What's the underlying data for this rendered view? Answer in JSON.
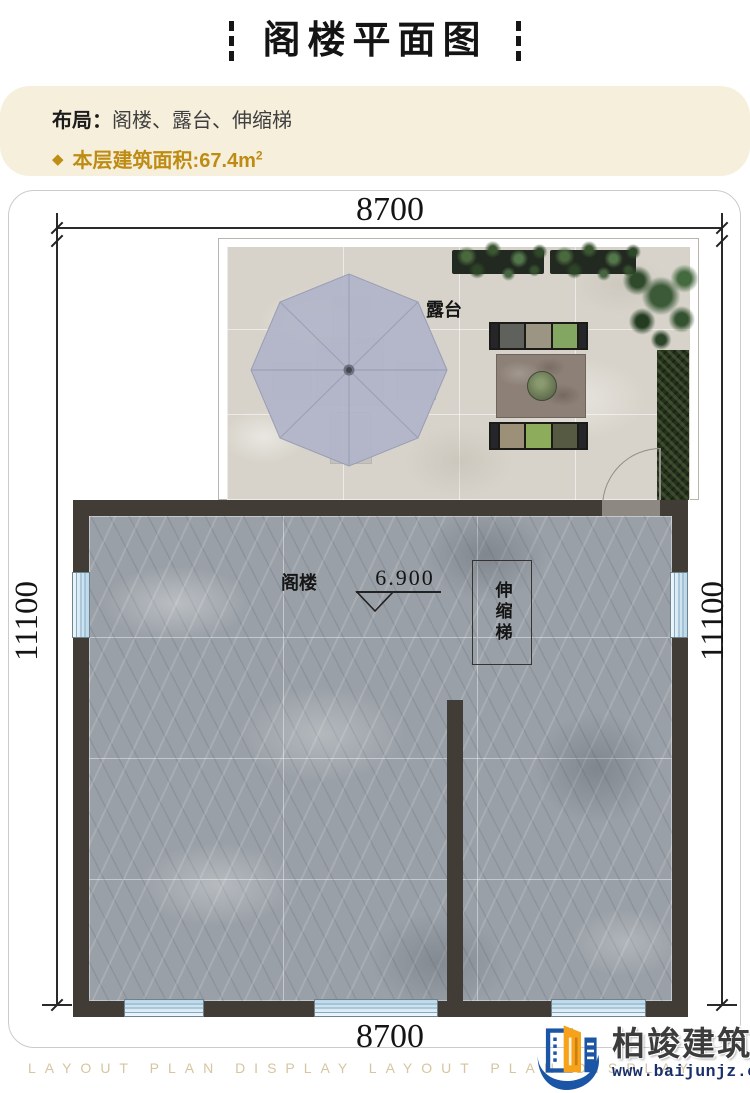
{
  "header": {
    "title": "阁楼平面图"
  },
  "info": {
    "layout_label": "布局：",
    "layout_value": "阁楼、露台、伸缩梯",
    "bullet": "◆",
    "area_label": "本层建筑面积:67.4m",
    "area_sup": "2",
    "accent_color": "#bf8c13",
    "bg_color": "#f6efdc"
  },
  "plan": {
    "dim_top": "8700",
    "dim_bottom": "8700",
    "dim_left": "11100",
    "dim_right": "11100",
    "terrace_label": "露台",
    "attic_label": "阁楼",
    "ladder_label": "伸缩梯",
    "elevation": "6.900",
    "colors": {
      "wall": "#413d36",
      "marble_floor": "#9aa0a7",
      "terrace_floor": "#d7d3ca",
      "umbrella": "#b1b5c8",
      "window": "#cfe4f2"
    }
  },
  "footer": {
    "watermark": "LAYOUT PLAN DISPLAY LAYOUT PLAN DISPLAY",
    "brand": "柏竣建筑",
    "url": "www.baijunjz.com",
    "brand_blue": "#1b55a5",
    "brand_orange": "#f6a21b"
  }
}
